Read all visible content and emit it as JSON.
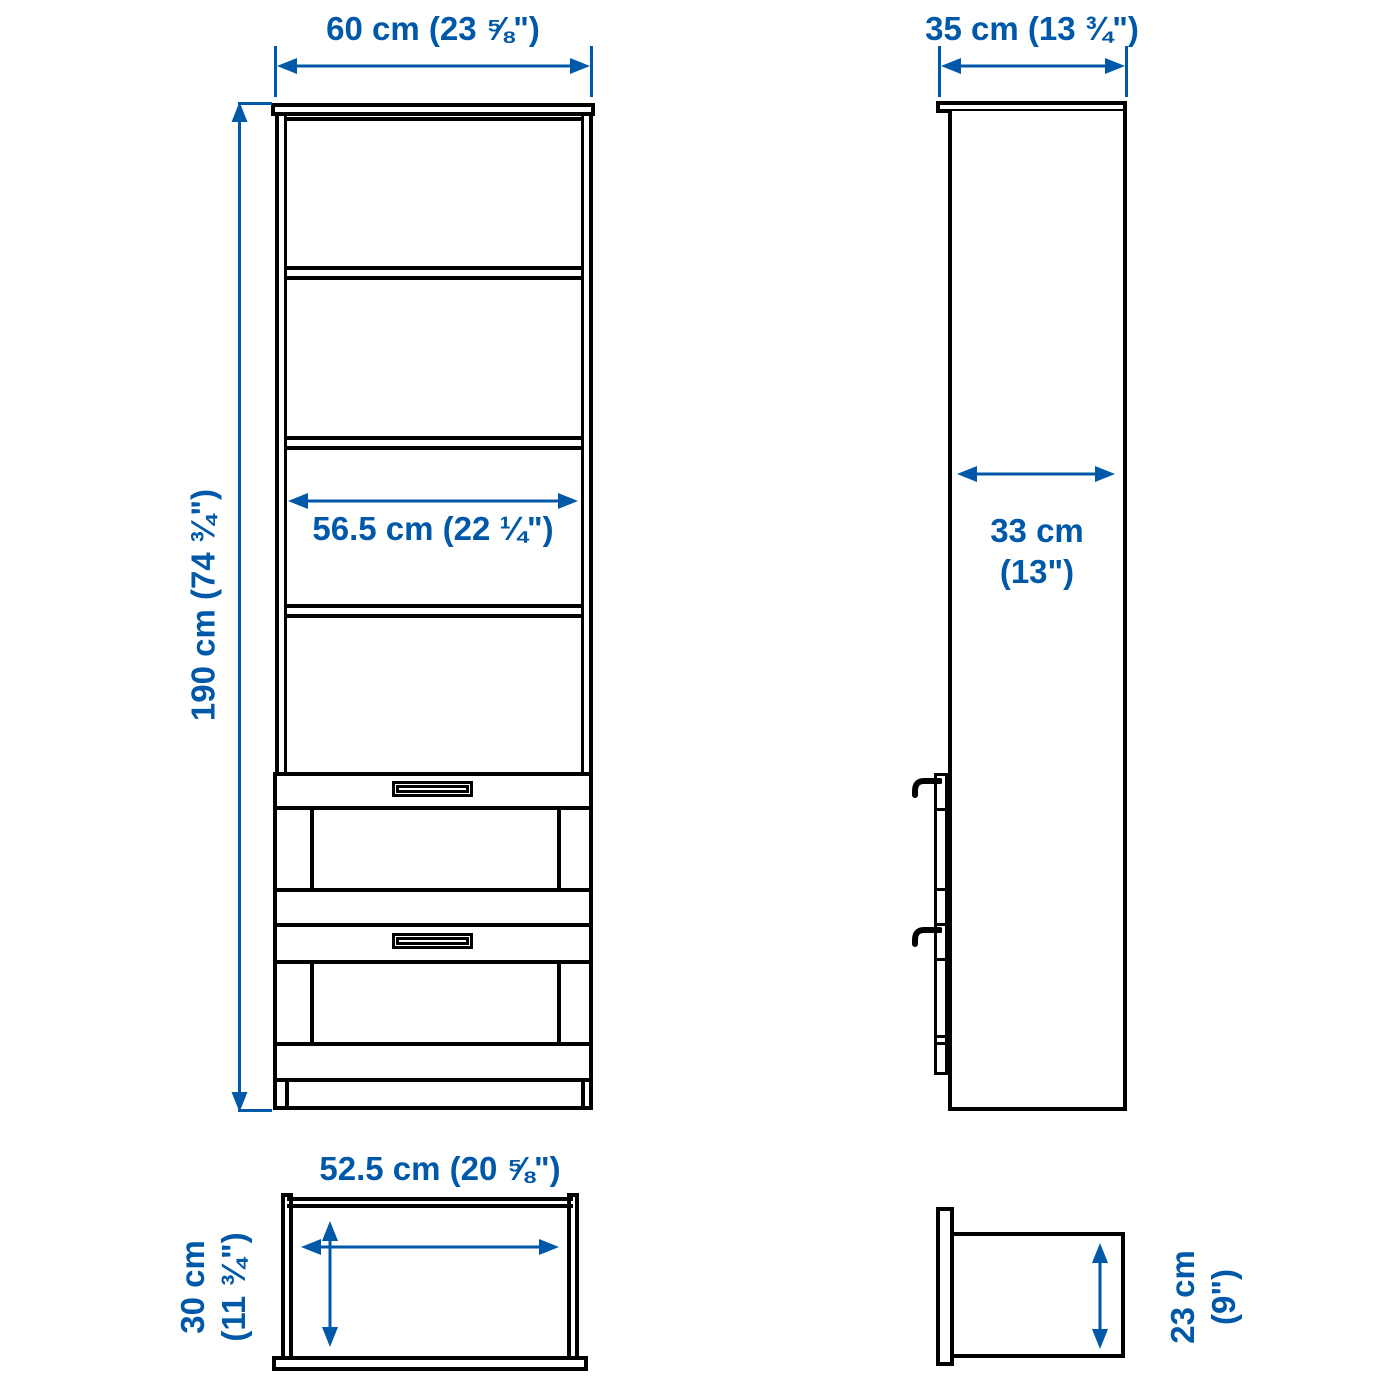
{
  "diagram": {
    "type": "product-dimension-diagram",
    "views": {
      "front": {
        "width": "60 cm (23 ⅝\")",
        "height": "190 cm (74 ¾\")",
        "inner_width": "56.5 cm (22 ¼\")"
      },
      "side": {
        "depth": "35 cm (13 ¾\")",
        "inner_depth_line1": "33 cm",
        "inner_depth_line2": "(13\")"
      },
      "drawer_top": {
        "width": "52.5 cm (20 ⅝\")",
        "depth_line1": "30 cm",
        "depth_line2": "(11 ¾\")"
      },
      "drawer_side": {
        "height_line1": "23 cm",
        "height_line2": "(9\")"
      }
    },
    "colors": {
      "dimension": "#0058A8",
      "outline": "#000000",
      "background": "#FFFFFF"
    }
  }
}
